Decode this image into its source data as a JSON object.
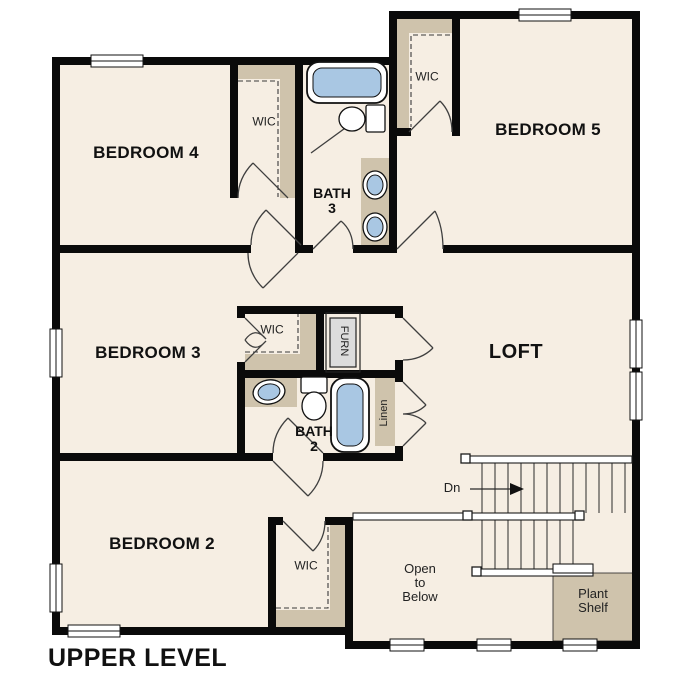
{
  "title": "UPPER LEVEL",
  "colors": {
    "floor": "#f6eee3",
    "shelf": "#cfc3ac",
    "wall": "#0a0a0a",
    "fixture_blue": "#a9c7e3",
    "line": "#3f3f3f",
    "text": "#111111",
    "furn_fill": "#dcdcdc"
  },
  "labels": {
    "bedroom4": "BEDROOM 4",
    "bedroom5": "BEDROOM 5",
    "bedroom3": "BEDROOM 3",
    "bedroom2": "BEDROOM 2",
    "loft": "LOFT",
    "bath3_line1": "BATH",
    "bath3_line2": "3",
    "bath2_line1": "BATH",
    "bath2_line2": "2",
    "wic_bedroom4": "WIC",
    "wic_bedroom5": "WIC",
    "wic_bedroom3": "WIC",
    "wic_bedroom2": "WIC",
    "furnace": "FURN",
    "linen": "Linen",
    "stairs_down": "Dn",
    "open_line1": "Open",
    "open_line2": "to",
    "open_line3": "Below",
    "plant_line1": "Plant",
    "plant_line2": "Shelf"
  }
}
